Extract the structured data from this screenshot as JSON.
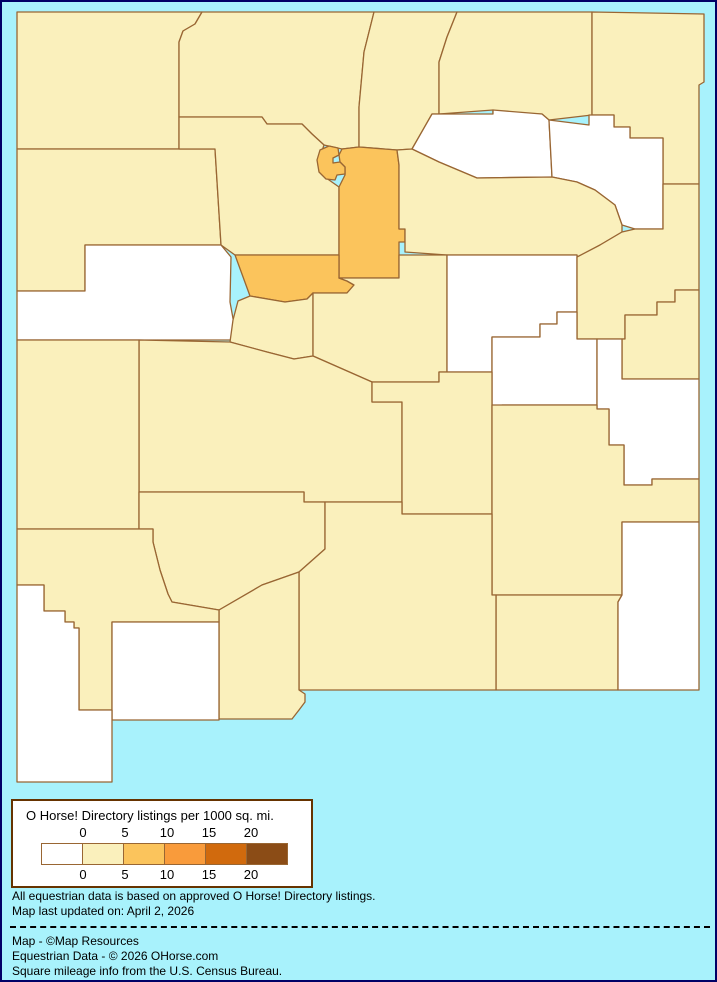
{
  "page": {
    "background": "#A8F2FC",
    "frame_color": "#000066"
  },
  "legend": {
    "title": "O Horse! Directory listings per 1000 sq. mi.",
    "boundary_labels": [
      "0",
      "5",
      "10",
      "15",
      "20"
    ],
    "swatch_colors": [
      "#FFFFFF",
      "#FAF0BC",
      "#FBC45C",
      "#F99B3B",
      "#D16A0D",
      "#8B4C16"
    ]
  },
  "notes": {
    "line1": "All equestrian data is based on approved O Horse! Directory listings.",
    "line2": "Map last updated on: April 2, 2026"
  },
  "credits": {
    "line1": "Map - ©Map Resources",
    "line2": "Equestrian Data - © 2026 OHorse.com",
    "line3": "Square mileage info from the U.S. Census Bureau."
  },
  "map": {
    "stroke": "#996633",
    "bucket_colors": {
      "0": "#FFFFFF",
      "1": "#FAF0BC",
      "2": "#FBC45C"
    },
    "counties": [
      {
        "id": "san-juan",
        "bucket": 1,
        "points": "15,10 200,10 193,22 181,29 177,40 177,147 15,147"
      },
      {
        "id": "rio-arriba",
        "bucket": 1,
        "points": "200,10 372,10 362,50 357,105 357,145 340,147 322,143 310,132 300,122 265,122 260,115 177,115 177,40 181,29 193,22"
      },
      {
        "id": "taos",
        "bucket": 1,
        "points": "372,10 455,10 445,35 437,60 437,112 430,112 410,147 395,148 357,145 357,105 362,50"
      },
      {
        "id": "colfax",
        "bucket": 1,
        "points": "455,10 590,10 590,113 547,118 540,112 491,112 491,108 437,112 437,60 445,35"
      },
      {
        "id": "union",
        "bucket": 1,
        "points": "590,10 702,12 702,80 697,83 697,182 661,182 661,136 628,136 628,125 612,125 612,113 590,113"
      },
      {
        "id": "mora",
        "bucket": 0,
        "points": "410,147 430,112 491,112 491,108 540,112 547,118 550,175 475,176 437,160"
      },
      {
        "id": "harding",
        "bucket": 0,
        "points": "547,118 587,123 587,113 612,113 612,125 628,125 628,136 661,136 661,227 633,227 620,223 613,203 593,188 575,180 550,175"
      },
      {
        "id": "mckinley",
        "bucket": 1,
        "points": "15,147 213,147 219,243 83,243 83,289 15,289"
      },
      {
        "id": "sandoval",
        "bucket": 1,
        "points": "177,115 260,115 265,122 300,122 310,132 322,143 318,155 316,163 318,170 327,178 337,185 337,253 233,253 219,243 213,147 177,147"
      },
      {
        "id": "santa-fe",
        "bucket": 2,
        "points": "357,145 395,148 397,163 397,227 403,227 403,240 397,240 397,276 337,276 337,185 343,173 343,165 338,160 337,153 340,147"
      },
      {
        "id": "san-miguel",
        "bucket": 1,
        "points": "395,148 410,147 437,160 475,176 550,175 575,180 593,188 613,203 620,223 620,230 598,243 577,255 575,255 575,253 445,253 403,250 403,227 397,227 397,163"
      },
      {
        "id": "cibola",
        "bucket": 0,
        "points": "83,243 219,243 229,255 228,300 232,322 230,338 15,338 15,289 83,289"
      },
      {
        "id": "bernalillo",
        "bucket": 2,
        "points": "233,253 337,253 337,276 345,279 352,283 345,291 311,291 305,297 283,300 248,294"
      },
      {
        "id": "valencia",
        "bucket": 1,
        "points": "236,299 248,294 283,300 305,297 311,291 311,354 292,357 265,350 228,340 231,318"
      },
      {
        "id": "torrance",
        "bucket": 1,
        "points": "311,291 345,291 352,283 345,279 337,276 397,276 397,253 445,253 445,370 437,370 437,380 370,380 311,354"
      },
      {
        "id": "guadalupe",
        "bucket": 0,
        "points": "445,253 575,253 575,310 555,310 555,322 538,322 538,335 490,335 490,370 445,370"
      },
      {
        "id": "quay",
        "bucket": 1,
        "points": "620,230 633,227 661,227 661,182 697,182 697,288 673,288 673,300 655,300 655,313 623,313 623,337 575,337 575,255 598,243"
      },
      {
        "id": "curry",
        "bucket": 1,
        "points": "623,337 623,313 655,313 655,300 673,300 673,288 697,288 697,377 620,377 620,337"
      },
      {
        "id": "de-baca",
        "bucket": 0,
        "points": "490,335 538,335 538,322 555,322 555,310 575,310 575,337 595,337 595,403 500,403 500,408 490,408"
      },
      {
        "id": "roosevelt",
        "bucket": 0,
        "points": "595,337 620,337 620,377 697,377 697,477 650,477 650,483 622,483 622,443 607,443 607,407 595,407"
      },
      {
        "id": "socorro",
        "bucket": 1,
        "points": "137,338 228,340 265,350 292,357 311,354 370,380 370,400 400,400 400,500 302,500 302,490 137,490"
      },
      {
        "id": "lincoln",
        "bucket": 1,
        "points": "370,380 437,380 437,370 490,370 490,512 400,512 400,400 370,400"
      },
      {
        "id": "chaves",
        "bucket": 1,
        "points": "490,403 595,403 595,407 607,407 607,443 622,443 622,483 650,483 650,477 697,477 697,520 620,520 620,593 490,593"
      },
      {
        "id": "eddy",
        "bucket": 1,
        "points": "494,593 620,593 616,600 616,688 494,688"
      },
      {
        "id": "lea",
        "bucket": 0,
        "points": "620,520 697,520 697,688 616,688 616,600 620,593"
      },
      {
        "id": "catron",
        "bucket": 1,
        "points": "15,338 137,338 137,527 15,527"
      },
      {
        "id": "sierra",
        "bucket": 1,
        "points": "137,490 302,490 302,500 323,500 323,547 297,570 260,583 217,608 170,600 166,592 158,568 151,540 151,527 137,527"
      },
      {
        "id": "otero",
        "bucket": 1,
        "points": "323,500 400,500 400,512 490,512 490,593 494,593 494,688 297,688 297,570 323,547"
      },
      {
        "id": "dona-ana",
        "bucket": 1,
        "points": "217,608 260,583 297,570 297,688 303,692 303,700 297,708 290,717 217,717"
      },
      {
        "id": "grant",
        "bucket": 1,
        "points": "15,527 151,527 151,540 158,568 166,592 170,600 217,608 217,620 110,620 110,708 77,708 77,626 72,626 72,620 63,620 63,609 42,609 42,583 15,583"
      },
      {
        "id": "luna",
        "bucket": 0,
        "points": "110,620 217,620 217,718 110,718"
      },
      {
        "id": "hidalgo",
        "bucket": 0,
        "points": "15,583 42,583 42,609 63,609 63,620 72,620 72,626 77,626 77,708 110,708 110,780 15,780"
      },
      {
        "id": "los-alamos",
        "bucket": 2,
        "points": "318,148 327,144 336,146 337,153 331,156 331,161 338,160 343,165 343,172 335,173 333,178 324,177 317,170 315,158"
      }
    ]
  }
}
